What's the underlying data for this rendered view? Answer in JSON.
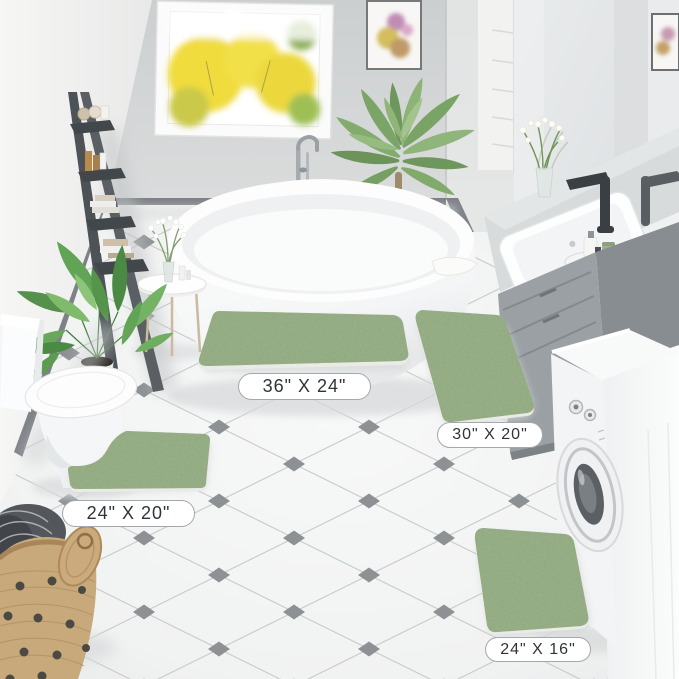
{
  "product_labels": [
    {
      "name": "main-rug",
      "size_text": "36\" X 24\""
    },
    {
      "name": "runner-rug",
      "size_text": "30\" X 20\""
    },
    {
      "name": "contour-rug",
      "size_text": "24\" X 20\""
    },
    {
      "name": "small-rug",
      "size_text": "24\" X 16\""
    }
  ],
  "colors": {
    "label_bg": "#ffffff",
    "label_border": "#a3a8ac",
    "label_text": "#2f3438",
    "rug_green": "#9cb38a",
    "rug_green_edge": "#e9ebe6",
    "wall_back": "#d2d4d5",
    "wall_left": "#f4f4f3",
    "baseboard": "#7e8286",
    "floor": "#f4f5f5",
    "grout": "#c9cccd",
    "tile_accent": "#8d9194",
    "ladder": "#4d5257",
    "cabinet": "#9aa0a4",
    "cabinet_dark": "#878c90",
    "basket": "#c8a97c",
    "plant_green": "#55904c",
    "palm_green": "#7ba468",
    "window_foliage": "#f0dc3c",
    "faucet_black": "#3a3f43",
    "tub_white": "#fdfdfe"
  }
}
